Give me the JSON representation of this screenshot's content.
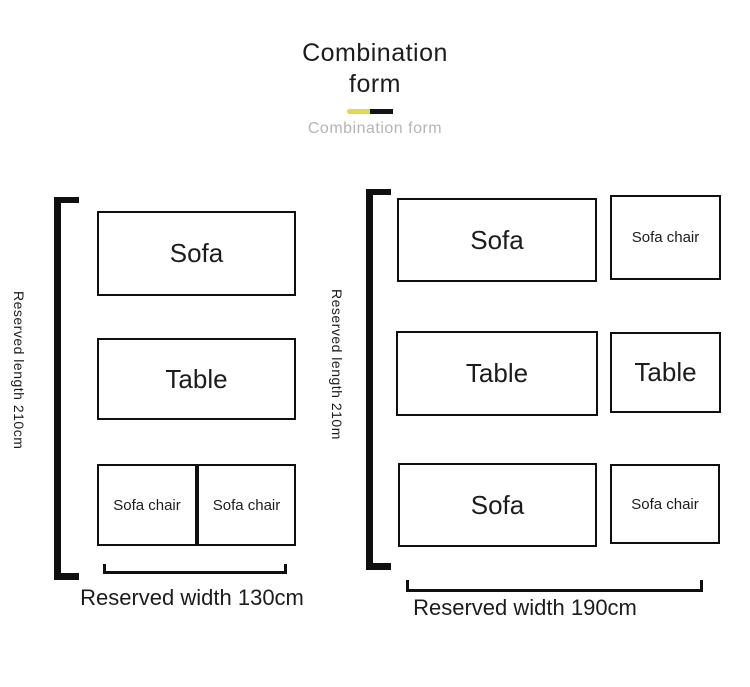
{
  "header": {
    "title_line1": "Combination",
    "title_line2": "form",
    "subtitle": "Combination form"
  },
  "colors": {
    "accent-yellow": "#e9d44b",
    "accent-black": "#141414",
    "line": "#0f0f0f",
    "text": "#1c1c1c",
    "muted": "#b5b5b5"
  },
  "left_diagram": {
    "length_label": "Reserved length 210cm",
    "width_label": "Reserved width 130cm",
    "sofa_label": "Sofa",
    "table_label": "Table",
    "chair_left_label": "Sofa chair",
    "chair_right_label": "Sofa chair"
  },
  "right_diagram": {
    "length_label": "Reserved length 210m",
    "width_label": "Reserved width 190cm",
    "row1_large": "Sofa",
    "row1_small": "Sofa chair",
    "row2_large": "Table",
    "row2_small": "Table",
    "row3_large": "Sofa",
    "row3_small": "Sofa chair"
  }
}
